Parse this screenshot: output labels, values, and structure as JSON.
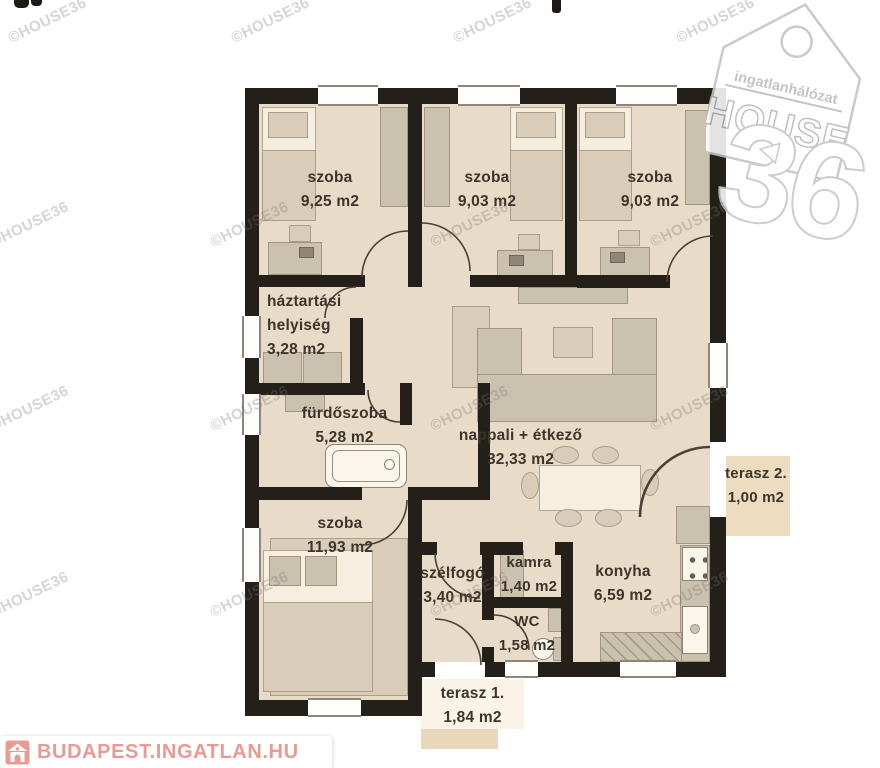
{
  "watermark": {
    "text": "©HOUSE36"
  },
  "logo": {
    "tagline": "ingatlanhálózat",
    "brand": "HOUSE",
    "number": "36"
  },
  "footer": {
    "brand": "BUDAPEST.INGATLAN.HU"
  },
  "colors": {
    "wall": "#241f19",
    "floor": "#e8dbc7",
    "terrace": "#eedcc0",
    "footer_accent": "#e89a93",
    "logo_outline": "#c3c3c3"
  },
  "rooms": [
    {
      "id": "szoba-1",
      "lines": [
        "szoba",
        "9,25 m2"
      ]
    },
    {
      "id": "szoba-2",
      "lines": [
        "szoba",
        "9,03 m2"
      ]
    },
    {
      "id": "szoba-3",
      "lines": [
        "szoba",
        "9,03 m2"
      ]
    },
    {
      "id": "haztartasi",
      "lines": [
        "háztartási",
        "helyiség",
        "3,28 m2"
      ]
    },
    {
      "id": "furdoszoba",
      "lines": [
        "fürdőszoba",
        "5,28 m2"
      ]
    },
    {
      "id": "nappali",
      "lines": [
        "nappali + étkező",
        "32,33 m2"
      ]
    },
    {
      "id": "szoba-4",
      "lines": [
        "szoba",
        "11,93 m2"
      ]
    },
    {
      "id": "szelfogo",
      "lines": [
        "szélfogó",
        "3,40 m2"
      ]
    },
    {
      "id": "kamra",
      "lines": [
        "kamra",
        "1,40 m2"
      ]
    },
    {
      "id": "wc",
      "lines": [
        "WC",
        "1,58 m2"
      ]
    },
    {
      "id": "konyha",
      "lines": [
        "konyha",
        "6,59 m2"
      ]
    },
    {
      "id": "terasz-2",
      "lines": [
        "terasz 2.",
        "1,00 m2"
      ]
    },
    {
      "id": "terasz-1",
      "lines": [
        "terasz 1.",
        "1,84 m2"
      ]
    }
  ]
}
